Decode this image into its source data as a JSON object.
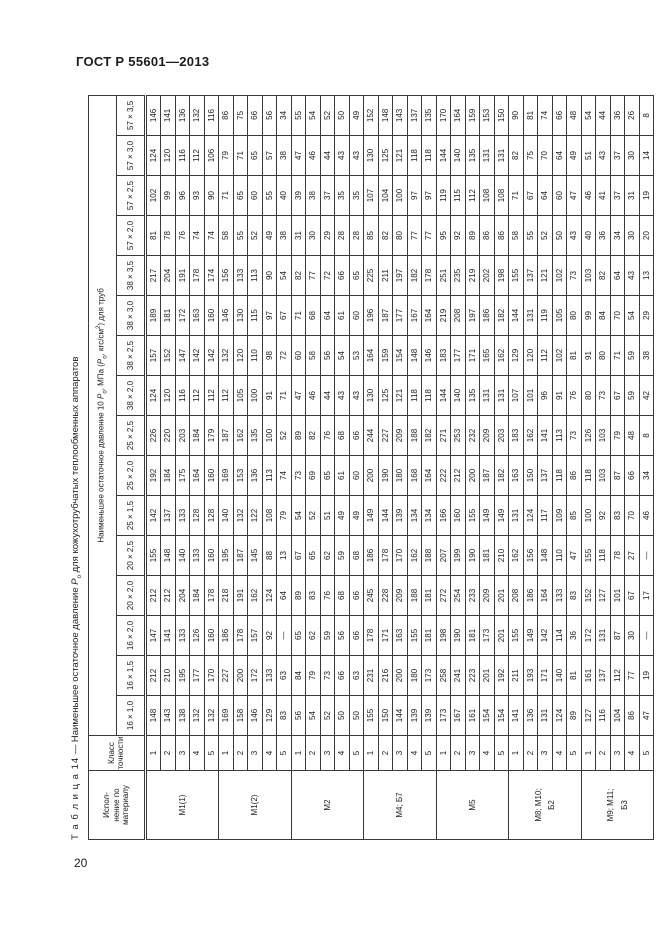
{
  "page": {
    "header": "ГОСТ Р 55601—2013",
    "page_number": "20"
  },
  "table": {
    "title_label": "Т а б л и ц а  14",
    "title_pre": " — Наименьшее остаточное давление ",
    "p_symbol": "Р",
    "p_sub": "о",
    "title_post": " для кожухотрубчатых теплообменных аппаратов",
    "material_header": "Испол-\nнение по\nматериалу",
    "class_header": "Класс\nточности",
    "span_header_pre": "Наименьшее остаточное давление 10  ",
    "span_header_mid": ", МПа (",
    "span_header_units": ", кгс/см",
    "span_header_sup": "2",
    "span_header_end": ") для труб",
    "columns": [
      "16 × 1,0",
      "16 × 1,5",
      "16 × 2,0",
      "20 × 2,0",
      "20 × 2,5",
      "25 × 1,5",
      "25 × 2,0",
      "25 × 2,5",
      "38 × 2,0",
      "38 × 2,5",
      "38 × 3,0",
      "38 × 3,5",
      "57 × 2,0",
      "57 × 2,5",
      "57 × 3,0",
      "57 × 3,5"
    ],
    "groups": [
      {
        "material": "М1(1)",
        "rows": [
          {
            "class": "1",
            "values": [
              "148",
              "212",
              "147",
              "212",
              "155",
              "142",
              "192",
              "226",
              "124",
              "157",
              "189",
              "217",
              "81",
              "102",
              "124",
              "146"
            ]
          },
          {
            "class": "2",
            "values": [
              "143",
              "210",
              "141",
              "212",
              "148",
              "137",
              "184",
              "220",
              "120",
              "152",
              "181",
              "204",
              "78",
              "99",
              "120",
              "141"
            ]
          },
          {
            "class": "3",
            "values": [
              "138",
              "195",
              "133",
              "204",
              "140",
              "133",
              "175",
              "203",
              "116",
              "147",
              "172",
              "191",
              "76",
              "96",
              "116",
              "136"
            ]
          },
          {
            "class": "4",
            "values": [
              "132",
              "177",
              "126",
              "184",
              "133",
              "128",
              "164",
              "184",
              "112",
              "142",
              "163",
              "178",
              "74",
              "93",
              "112",
              "132"
            ]
          },
          {
            "class": "5",
            "values": [
              "132",
              "170",
              "160",
              "178",
              "160",
              "128",
              "160",
              "179",
              "112",
              "142",
              "160",
              "174",
              "74",
              "90",
              "106",
              "116"
            ]
          }
        ]
      },
      {
        "material": "М1(2)",
        "rows": [
          {
            "class": "1",
            "values": [
              "169",
              "227",
              "186",
              "218",
              "195",
              "140",
              "169",
              "187",
              "112",
              "132",
              "146",
              "156",
              "58",
              "71",
              "79",
              "86"
            ]
          },
          {
            "class": "2",
            "values": [
              "158",
              "200",
              "178",
              "191",
              "187",
              "132",
              "153",
              "162",
              "105",
              "120",
              "130",
              "133",
              "55",
              "65",
              "71",
              "75"
            ]
          },
          {
            "class": "3",
            "values": [
              "146",
              "172",
              "157",
              "162",
              "145",
              "122",
              "136",
              "135",
              "100",
              "110",
              "115",
              "113",
              "52",
              "60",
              "65",
              "66"
            ]
          },
          {
            "class": "4",
            "values": [
              "129",
              "133",
              "92",
              "124",
              "88",
              "108",
              "113",
              "100",
              "91",
              "98",
              "97",
              "90",
              "49",
              "55",
              "57",
              "56"
            ]
          },
          {
            "class": "5",
            "values": [
              "83",
              "63",
              "—",
              "64",
              "13",
              "79",
              "74",
              "52",
              "71",
              "72",
              "67",
              "54",
              "38",
              "40",
              "38",
              "34"
            ]
          }
        ]
      },
      {
        "material": "М2",
        "rows": [
          {
            "class": "1",
            "values": [
              "56",
              "84",
              "65",
              "89",
              "67",
              "54",
              "73",
              "89",
              "47",
              "60",
              "71",
              "82",
              "31",
              "39",
              "47",
              "55"
            ]
          },
          {
            "class": "2",
            "values": [
              "54",
              "79",
              "62",
              "83",
              "65",
              "52",
              "69",
              "82",
              "46",
              "58",
              "68",
              "77",
              "30",
              "38",
              "46",
              "54"
            ]
          },
          {
            "class": "3",
            "values": [
              "52",
              "73",
              "59",
              "76",
              "62",
              "51",
              "65",
              "76",
              "44",
              "56",
              "64",
              "72",
              "29",
              "37",
              "44",
              "52"
            ]
          },
          {
            "class": "4",
            "values": [
              "50",
              "66",
              "56",
              "68",
              "59",
              "49",
              "61",
              "68",
              "43",
              "54",
              "61",
              "66",
              "28",
              "35",
              "43",
              "50"
            ]
          },
          {
            "class": "5",
            "values": [
              "50",
              "63",
              "66",
              "66",
              "68",
              "49",
              "60",
              "66",
              "43",
              "53",
              "60",
              "65",
              "28",
              "35",
              "43",
              "49"
            ]
          }
        ]
      },
      {
        "material": "М4; Б7",
        "rows": [
          {
            "class": "1",
            "values": [
              "155",
              "231",
              "178",
              "245",
              "186",
              "149",
              "200",
              "244",
              "130",
              "164",
              "196",
              "225",
              "85",
              "107",
              "130",
              "152"
            ]
          },
          {
            "class": "2",
            "values": [
              "150",
              "216",
              "171",
              "228",
              "178",
              "144",
              "190",
              "227",
              "125",
              "159",
              "187",
              "211",
              "82",
              "104",
              "125",
              "148"
            ]
          },
          {
            "class": "3",
            "values": [
              "144",
              "200",
              "163",
              "209",
              "170",
              "139",
              "180",
              "209",
              "121",
              "154",
              "177",
              "197",
              "80",
              "100",
              "121",
              "143"
            ]
          },
          {
            "class": "4",
            "values": [
              "139",
              "180",
              "155",
              "188",
              "162",
              "134",
              "168",
              "188",
              "118",
              "148",
              "167",
              "182",
              "77",
              "97",
              "118",
              "137"
            ]
          },
          {
            "class": "5",
            "values": [
              "139",
              "173",
              "181",
              "181",
              "188",
              "134",
              "164",
              "182",
              "118",
              "146",
              "164",
              "178",
              "77",
              "97",
              "118",
              "135"
            ]
          }
        ]
      },
      {
        "material": "М5",
        "rows": [
          {
            "class": "1",
            "values": [
              "173",
              "258",
              "198",
              "272",
              "207",
              "166",
              "222",
              "271",
              "144",
              "183",
              "219",
              "251",
              "95",
              "119",
              "144",
              "170"
            ]
          },
          {
            "class": "2",
            "values": [
              "167",
              "241",
              "190",
              "254",
              "199",
              "160",
              "212",
              "253",
              "140",
              "177",
              "208",
              "235",
              "92",
              "115",
              "140",
              "164"
            ]
          },
          {
            "class": "3",
            "values": [
              "161",
              "223",
              "181",
              "233",
              "190",
              "155",
              "200",
              "232",
              "135",
              "171",
              "197",
              "219",
              "89",
              "112",
              "135",
              "159"
            ]
          },
          {
            "class": "4",
            "values": [
              "154",
              "201",
              "173",
              "209",
              "181",
              "149",
              "187",
              "209",
              "131",
              "165",
              "186",
              "202",
              "86",
              "108",
              "131",
              "153"
            ]
          },
          {
            "class": "5",
            "values": [
              "154",
              "192",
              "201",
              "201",
              "210",
              "149",
              "182",
              "203",
              "131",
              "162",
              "182",
              "198",
              "86",
              "108",
              "131",
              "150"
            ]
          }
        ]
      },
      {
        "material": "М8; М10;\nБ2",
        "rows": [
          {
            "class": "1",
            "values": [
              "141",
              "211",
              "155",
              "208",
              "162",
              "131",
              "163",
              "183",
              "107",
              "129",
              "144",
              "155",
              "58",
              "71",
              "82",
              "90"
            ]
          },
          {
            "class": "2",
            "values": [
              "136",
              "193",
              "149",
              "186",
              "156",
              "124",
              "150",
              "162",
              "101",
              "120",
              "131",
              "137",
              "55",
              "67",
              "75",
              "81"
            ]
          },
          {
            "class": "3",
            "values": [
              "131",
              "171",
              "142",
              "164",
              "148",
              "117",
              "137",
              "141",
              "96",
              "112",
              "119",
              "121",
              "52",
              "64",
              "70",
              "74"
            ]
          },
          {
            "class": "4",
            "values": [
              "124",
              "140",
              "114",
              "133",
              "110",
              "109",
              "118",
              "113",
              "91",
              "102",
              "105",
              "102",
              "50",
              "60",
              "64",
              "66"
            ]
          },
          {
            "class": "5",
            "values": [
              "89",
              "81",
              "36",
              "83",
              "47",
              "85",
              "86",
              "73",
              "76",
              "81",
              "80",
              "73",
              "43",
              "47",
              "49",
              "48"
            ]
          }
        ]
      },
      {
        "material": "М9; М11;\nБ3",
        "rows": [
          {
            "class": "1",
            "values": [
              "127",
              "161",
              "172",
              "152",
              "155",
              "100",
              "118",
              "126",
              "80",
              "91",
              "99",
              "103",
              "40",
              "46",
              "51",
              "54"
            ]
          },
          {
            "class": "2",
            "values": [
              "116",
              "137",
              "131",
              "127",
              "118",
              "92",
              "103",
              "103",
              "73",
              "80",
              "84",
              "82",
              "36",
              "41",
              "43",
              "44"
            ]
          },
          {
            "class": "3",
            "values": [
              "104",
              "112",
              "87",
              "101",
              "78",
              "83",
              "87",
              "79",
              "67",
              "71",
              "70",
              "64",
              "34",
              "37",
              "37",
              "36"
            ]
          },
          {
            "class": "4",
            "values": [
              "86",
              "77",
              "30",
              "67",
              "27",
              "70",
              "66",
              "48",
              "59",
              "59",
              "54",
              "43",
              "30",
              "31",
              "30",
              "26"
            ]
          },
          {
            "class": "5",
            "values": [
              "47",
              "19",
              "—",
              "17",
              "—",
              "46",
              "34",
              "8",
              "42",
              "38",
              "29",
              "13",
              "20",
              "19",
              "14",
              "8"
            ]
          }
        ]
      }
    ]
  }
}
